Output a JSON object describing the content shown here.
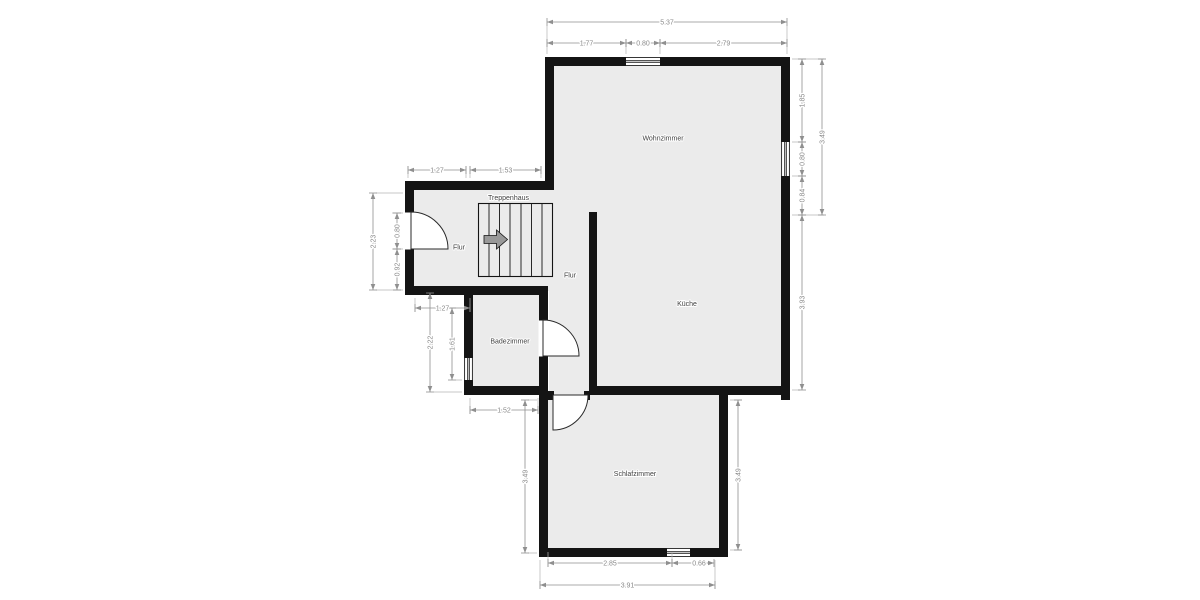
{
  "rooms": {
    "wohnzimmer": "Wohnzimmer",
    "kueche": "Küche",
    "flur_upper": "Flur",
    "flur_lower": "Flur",
    "badezimmer": "Badezimmer",
    "schlafzimmer": "Schlafzimmer",
    "treppenhaus": "Treppenhaus"
  },
  "dims": {
    "top_total": "5.37",
    "top_seg1": "1.77",
    "top_window": "0.80",
    "top_seg2": "2.79",
    "hall_top_seg1": "1.27",
    "hall_top_seg2": "1.53",
    "left_total": "2.23",
    "left_door": "0.80",
    "left_seg": "0.92",
    "bath_top": "1.27",
    "bath_height_outer": "2.22",
    "bath_height_inner": "1.61",
    "bath_width": "1.52",
    "right_seg1": "1.85",
    "right_window": "0.80",
    "right_seg2": "0.84",
    "right_upper_total": "3.49",
    "right_lower": "3.93",
    "bed_left_height": "3.49",
    "bed_right_height": "3.49",
    "bed_bottom_seg": "2.85",
    "bed_bottom_window": "0.66",
    "bed_bottom_total": "3.91"
  },
  "colors": {
    "wall": "#141414",
    "floor_fill": "#ebebeb",
    "dim_line": "#8f8f8f",
    "dim_text": "#8a8a8a",
    "room_text": "#3f3f3f",
    "background": "#ffffff"
  }
}
